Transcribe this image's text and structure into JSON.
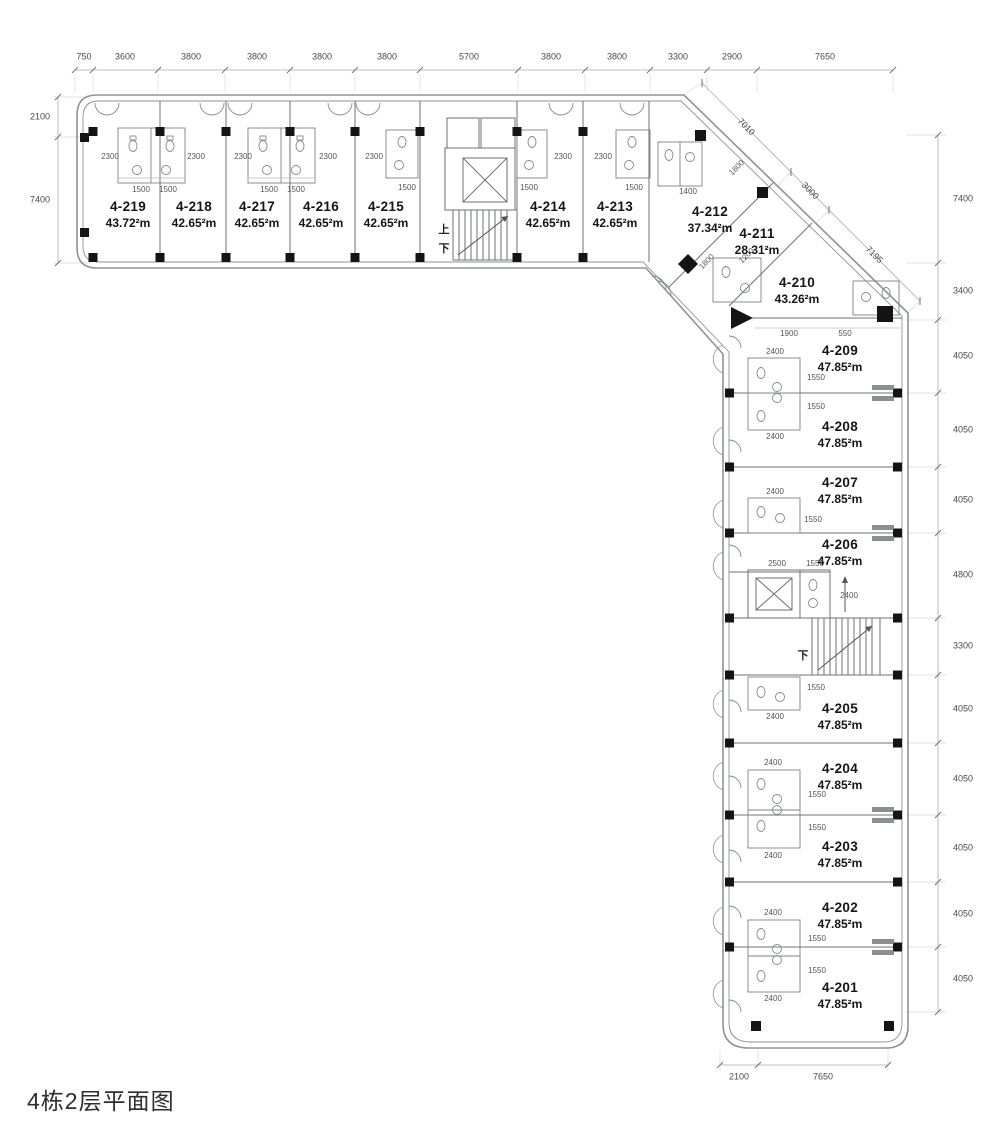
{
  "title": "4栋2层平面图",
  "plan": {
    "stairs": {
      "up": "上",
      "down": "下"
    },
    "rooms": [
      {
        "id": "4-219",
        "area": "43.72²m"
      },
      {
        "id": "4-218",
        "area": "42.65²m"
      },
      {
        "id": "4-217",
        "area": "42.65²m"
      },
      {
        "id": "4-216",
        "area": "42.65²m"
      },
      {
        "id": "4-215",
        "area": "42.65²m"
      },
      {
        "id": "4-214",
        "area": "42.65²m"
      },
      {
        "id": "4-213",
        "area": "42.65²m"
      },
      {
        "id": "4-212",
        "area": "37.34²m"
      },
      {
        "id": "4-211",
        "area": "28.31²m"
      },
      {
        "id": "4-210",
        "area": "43.26²m"
      },
      {
        "id": "4-209",
        "area": "47.85²m"
      },
      {
        "id": "4-208",
        "area": "47.85²m"
      },
      {
        "id": "4-207",
        "area": "47.85²m"
      },
      {
        "id": "4-206",
        "area": "47.85²m"
      },
      {
        "id": "4-205",
        "area": "47.85²m"
      },
      {
        "id": "4-204",
        "area": "47.85²m"
      },
      {
        "id": "4-203",
        "area": "47.85²m"
      },
      {
        "id": "4-202",
        "area": "47.85²m"
      },
      {
        "id": "4-201",
        "area": "47.85²m"
      }
    ],
    "dimensions": {
      "top": [
        "750",
        "3600",
        "3800",
        "3800",
        "3800",
        "3800",
        "5700",
        "3800",
        "3800",
        "3300",
        "2900",
        "7650"
      ],
      "left": [
        "2100",
        "7400"
      ],
      "right": [
        "7400",
        "3400",
        "4050",
        "4050",
        "4050",
        "4800",
        "3300",
        "4050",
        "4050",
        "4050",
        "4050",
        "4050"
      ],
      "bottom": [
        "2100",
        "7650"
      ],
      "diagonal": [
        "7010",
        "3000",
        "7195"
      ],
      "interior": [
        "2300",
        "2300",
        "2300",
        "2300",
        "2300",
        "2300",
        "2300",
        "1500",
        "1500",
        "1500",
        "1500",
        "1500",
        "1500",
        "1500",
        "1400",
        "1800",
        "1800",
        "1200",
        "1900",
        "550",
        "2400",
        "1550",
        "1550",
        "2400",
        "2400",
        "1550",
        "2500",
        "1550",
        "2400",
        "1550",
        "2400",
        "2400",
        "1550",
        "1550",
        "2400",
        "2400",
        "1550",
        "1550",
        "2400"
      ]
    }
  }
}
